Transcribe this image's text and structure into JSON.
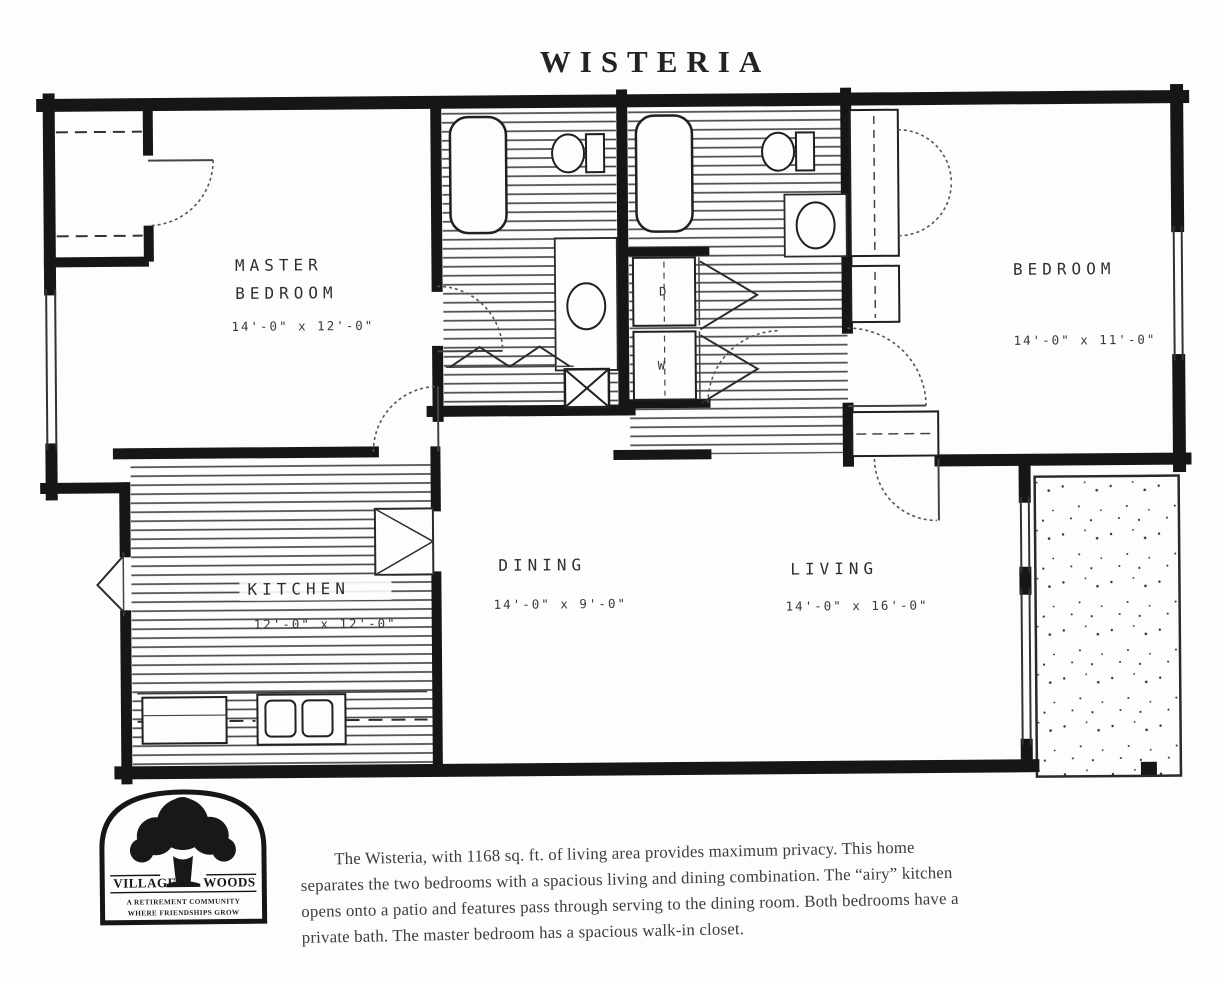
{
  "title": "WISTERIA",
  "colors": {
    "paper": "#fdfdfb",
    "ink": "#161616",
    "plan_label": "#2e2e2e",
    "body_text": "#3c3c3c"
  },
  "plan": {
    "master_bedroom": {
      "name_line1": "MASTER",
      "name_line2": "BEDROOM",
      "dims": "14'-0\" x 12'-0\""
    },
    "bedroom": {
      "name": "BEDROOM",
      "dims": "14'-0\" x 11'-0\""
    },
    "kitchen": {
      "name": "KITCHEN",
      "dims": "12'-0\" x 12'-0\""
    },
    "dining": {
      "name": "DINING",
      "dims": "14'-0\" x 9'-0\""
    },
    "living": {
      "name": "LIVING",
      "dims": "14'-0\" x 16'-0\""
    },
    "laundry": {
      "dryer": "D",
      "washer": "W"
    }
  },
  "logo": {
    "name_left": "VILLAGE",
    "name_right": "WOODS",
    "tagline_line1": "A RETIREMENT COMMUNITY",
    "tagline_line2": "WHERE FRIENDSHIPS GROW"
  },
  "description": "The Wisteria, with 1168 sq. ft. of living area provides maximum privacy. This home separates the two bedrooms with a spacious living and dining combination. The “airy” kitchen opens onto a patio and features pass through serving to the dining room. Both bedrooms have a private bath. The master bedroom has a spacious walk-in closet."
}
